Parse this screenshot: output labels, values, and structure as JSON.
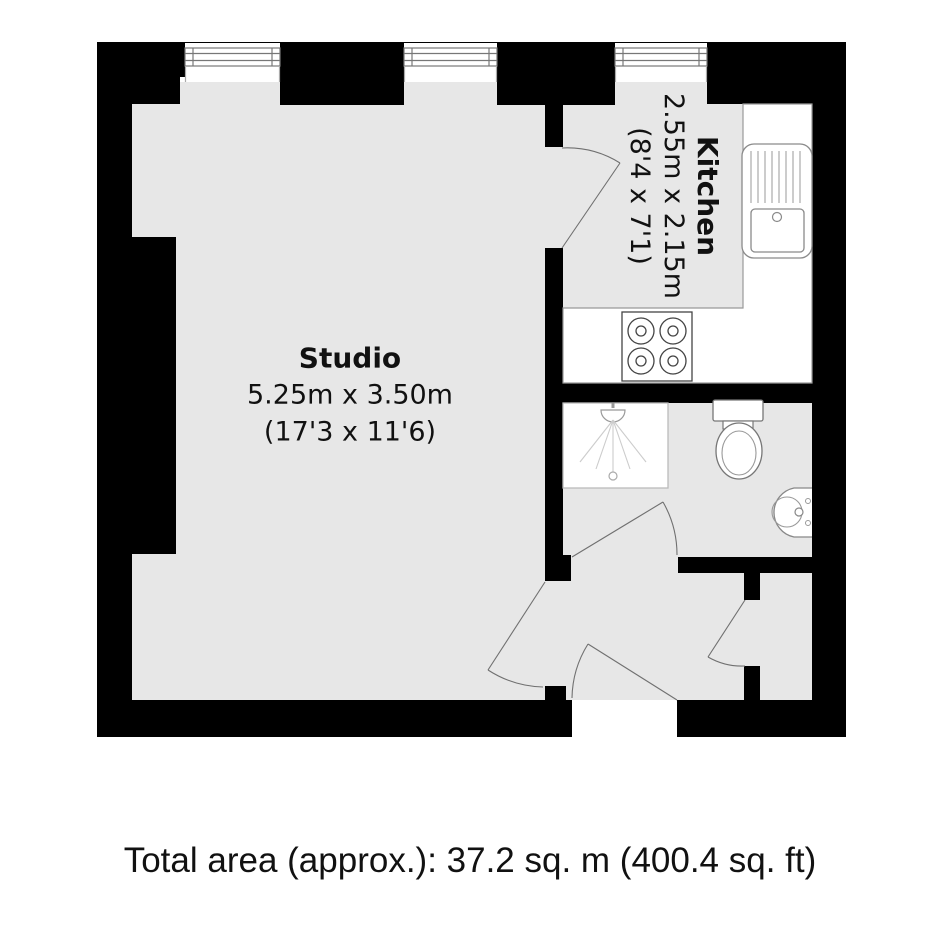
{
  "plan": {
    "rooms": {
      "studio": {
        "name": "Studio",
        "dims_metric": "5.25m x 3.50m",
        "dims_imperial": "(17'3 x 11'6)"
      },
      "kitchen": {
        "name": "Kitchen",
        "dims_metric": "2.55m x 2.15m",
        "dims_imperial": "(8'4 x 7'1)"
      }
    },
    "caption": "Total area (approx.): 37.2 sq. m (400.4 sq. ft)",
    "colors": {
      "wall": "#000000",
      "floor": "#e7e7e7",
      "fixture": "#8a8a8a",
      "fixture-dark": "#444444",
      "fixture-light": "#bbbbbb",
      "door": "#707070",
      "text": "#111111"
    }
  }
}
